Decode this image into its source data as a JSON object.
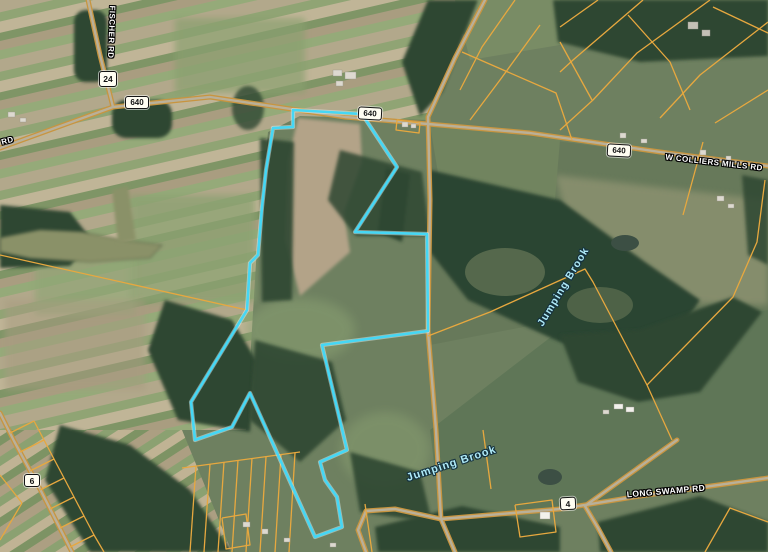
{
  "map": {
    "description": "Aerial imagery parcel map with one parcel highlighted in cyan",
    "colors": {
      "parcel_highlight": "#45d7f5",
      "parcel_lines": "#e7a83f",
      "road_casing": "#c89540",
      "stream_label": "#aee9f6"
    },
    "road_labels": [
      {
        "id": "fischer-rd",
        "text": "FISCHER RD"
      },
      {
        "id": "colliers-mills-rd-partial",
        "text": "LS RD"
      },
      {
        "id": "w-colliers-mills-rd",
        "text": "W COLLIERS MILLS RD"
      },
      {
        "id": "long-swamp-rd",
        "text": "LONG SWAMP RD"
      }
    ],
    "route_shields": [
      {
        "id": "route-24",
        "number": "24"
      },
      {
        "id": "route-640-west",
        "number": "640"
      },
      {
        "id": "route-640-center",
        "number": "640"
      },
      {
        "id": "route-640-east",
        "number": "640"
      },
      {
        "id": "route-6",
        "number": "6"
      },
      {
        "id": "route-4",
        "number": "4"
      }
    ],
    "water_labels": [
      {
        "id": "jumping-brook-upper",
        "text": "Jumping Brook"
      },
      {
        "id": "jumping-brook-lower",
        "text": "Jumping Brook"
      }
    ]
  }
}
